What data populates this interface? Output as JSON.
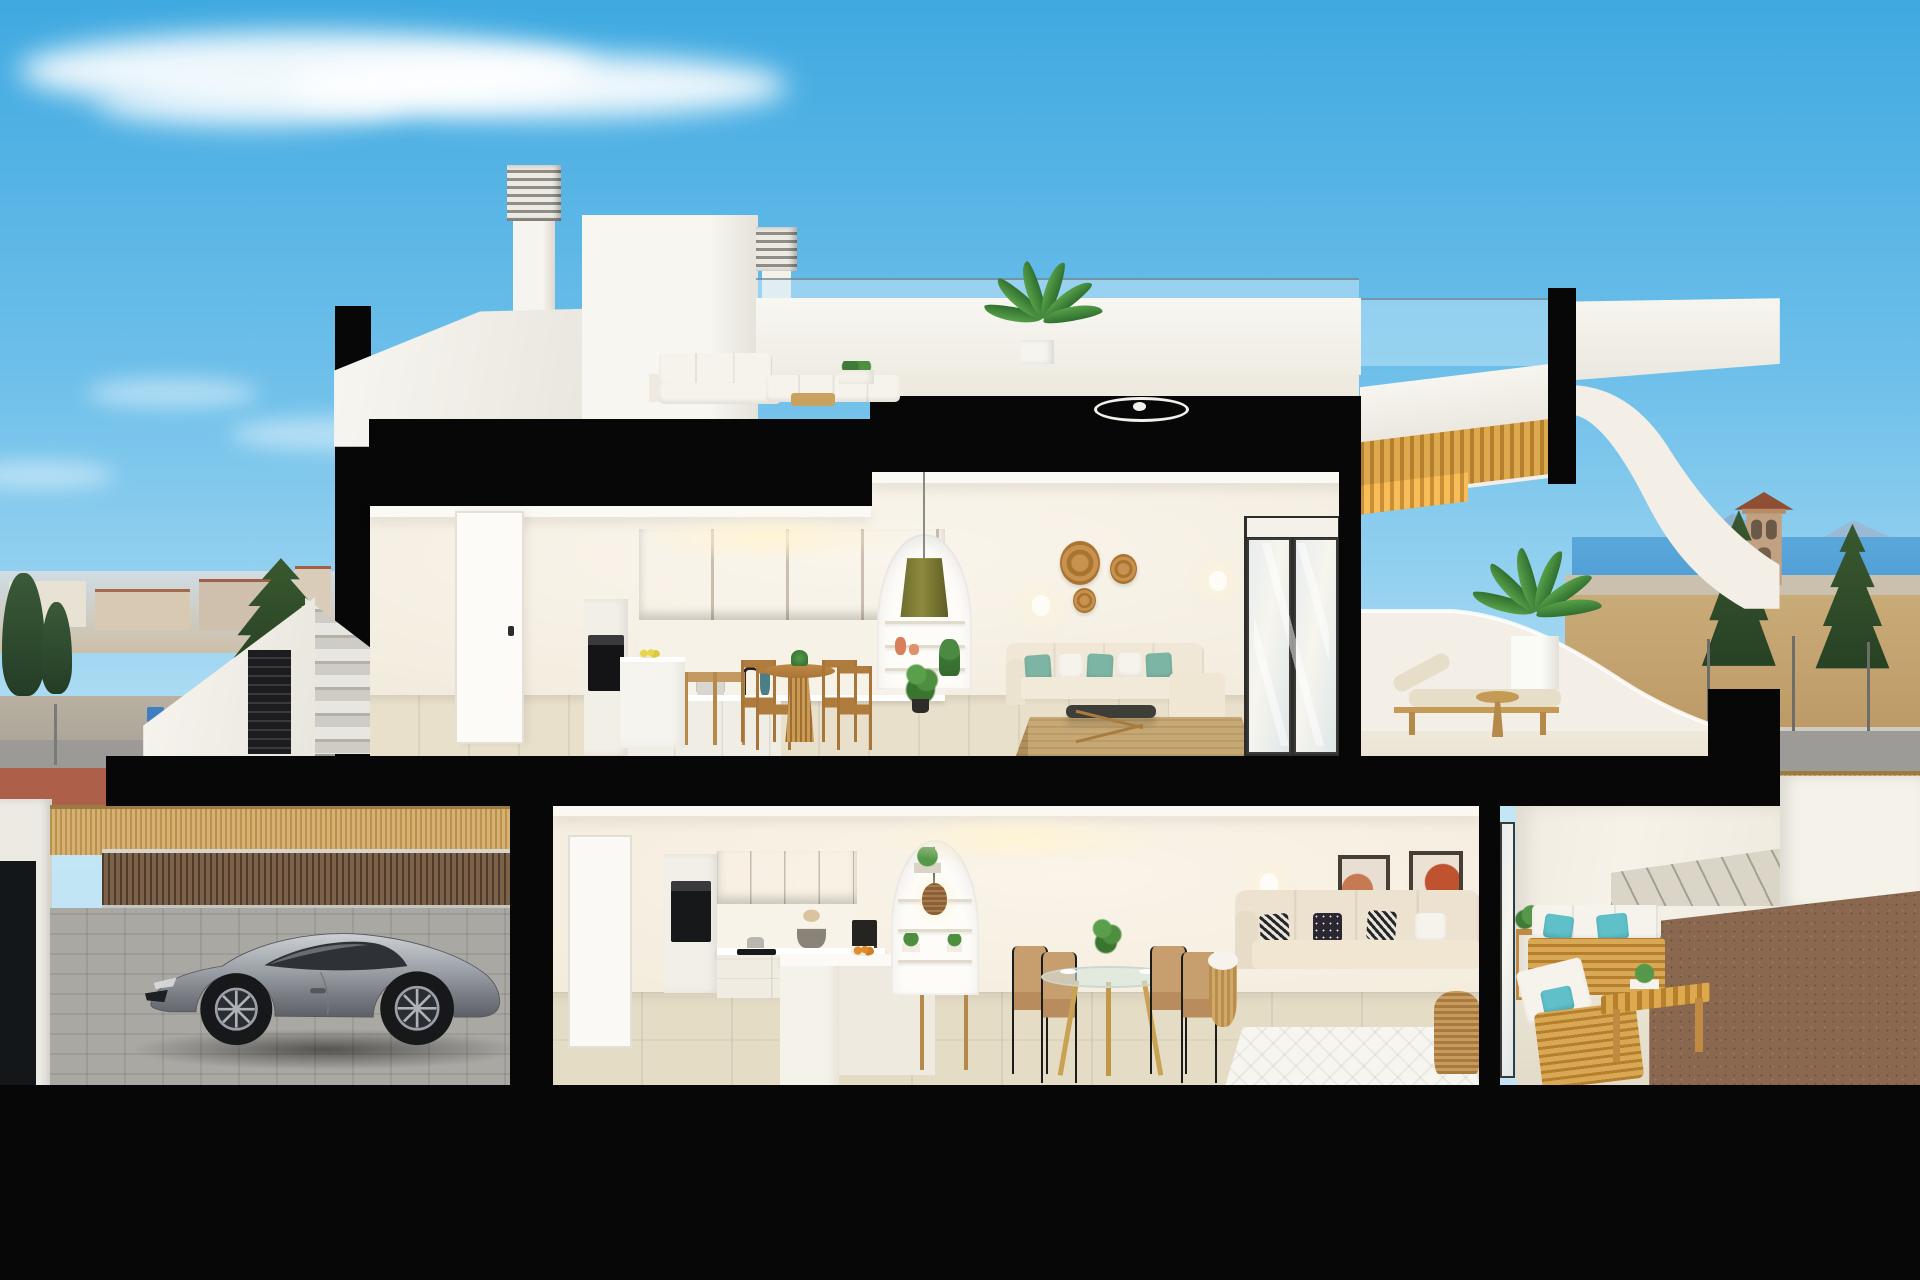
{
  "meta": {
    "type": "3d-architectural-cross-section-render",
    "label": "Cutaway section of a modern two-storey coastal townhouse",
    "setting": "Mediterranean residential street, daytime, sea and mountains on the horizon",
    "no_visible_text": true
  },
  "palette": {
    "sky_top": "#3fa9e0",
    "sky_horizon": "#bfe2f4",
    "cloud": "#ffffff",
    "cut_plane_black": "#070708",
    "wall_white": "#f5f2ea",
    "interior_wall": "#f7f1e6",
    "floor_tile": "#e8dfca",
    "oak_cabinet": "#d9b26f",
    "timber_soffit": "#d2a032",
    "teal_cushion": "#7db5a4",
    "turquoise_pillow": "#5fc0c9",
    "sea": "#4f9dd6",
    "dry_field": "#c1a06e",
    "road": "#9c9b97",
    "red_bike_path": "#ad5f49",
    "reed_fence": "#cfa963",
    "timber_slats": "#6e5742",
    "car_silver": "#9aa0a6",
    "plant_green": "#4e8f3f",
    "jute_rug": "#c7a873",
    "rattan": "#b9894e"
  },
  "scene": {
    "sky": {
      "label": "clear blue sky with wispy cirrus clouds"
    },
    "background": {
      "left_town": {
        "label": "distant town with terracotta roofs",
        "objects": [
          "low white houses",
          "apartment blocks",
          "cypress trees",
          "tall pine",
          "street with red bike path",
          "blue street sign"
        ]
      },
      "right_coast": {
        "label": "coastal plain",
        "objects": [
          "historic watchtower",
          "pine trees",
          "sea horizon",
          "blue mountains",
          "street lamps",
          "reed fence",
          "dry field",
          "neighbour wall"
        ]
      }
    },
    "building": {
      "label": "cutaway two-storey townhouse section",
      "roof": {
        "label": "roof terrace",
        "objects": [
          "stair bulkhead",
          "louvered chimney",
          "second louvered chimney",
          "white outdoor lounge set",
          "planter boxes",
          "potted palm",
          "glass railing",
          "ceiling fan on deck",
          "curved white balustrade",
          "timber stair soffit"
        ]
      },
      "upper_floor": {
        "label": "upper apartment",
        "kitchen": {
          "objects": [
            "oak upper cabinets",
            "built-in oven tower",
            "white base units",
            "white island",
            "two oak bar stools",
            "bowl of lemons",
            "teal vase",
            "pot on counter"
          ]
        },
        "dining": {
          "objects": [
            "round oak pedestal table",
            "four oak chairs",
            "table setting"
          ]
        },
        "living": {
          "objects": [
            "arched shelving niche",
            "olive pendant lamp",
            "orange vases",
            "trailing plant",
            "cream sofa with teal cushions",
            "dark-top coffee table",
            "striped jute rug",
            "three rattan wall baskets",
            "two wall sconces",
            "sliding glass door",
            "white entry door"
          ]
        },
        "terrace": {
          "objects": [
            "wooden sun lounger with beige cushion",
            "round wooden side table",
            "palm in white planter",
            "curved white parapet"
          ]
        }
      },
      "lower_floor": {
        "label": "ground-floor apartment",
        "kitchen": {
          "objects": [
            "oak upper cabinets",
            "tall oven cabinet",
            "induction hob",
            "kettle",
            "black coffee machine",
            "white peninsula island",
            "bowl of oranges",
            "wooden stool",
            "pampas decor"
          ]
        },
        "dining": {
          "objects": [
            "round glass table on timber legs",
            "four tan chairs with black legs",
            "plant centerpiece",
            "white plates"
          ]
        },
        "living": {
          "objects": [
            "arched shelving niche",
            "rattan pendant lamp",
            "potted plants",
            "two abstract framed artworks",
            "beige sofa with black and white cushions",
            "rattan coffee table",
            "white diamond-pattern rug",
            "basket with throw",
            "wall sconce",
            "sliding glass door"
          ]
        },
        "terrace": {
          "objects": [
            "two teak outdoor sofas with white cushions",
            "turquoise pillows",
            "slatted teak coffee bench",
            "teak side table",
            "potted plants",
            "paver path",
            "brown gravel bed"
          ]
        }
      },
      "garage": {
        "label": "street-level carport",
        "objects": [
          "silver sports coupe",
          "timber slat wall",
          "reed privacy fence",
          "cobbled driveway",
          "dark gate opening"
        ]
      },
      "exterior": {
        "objects": [
          "external staircase with white parapet",
          "dark louvered gate",
          "concrete steps"
        ]
      }
    }
  }
}
